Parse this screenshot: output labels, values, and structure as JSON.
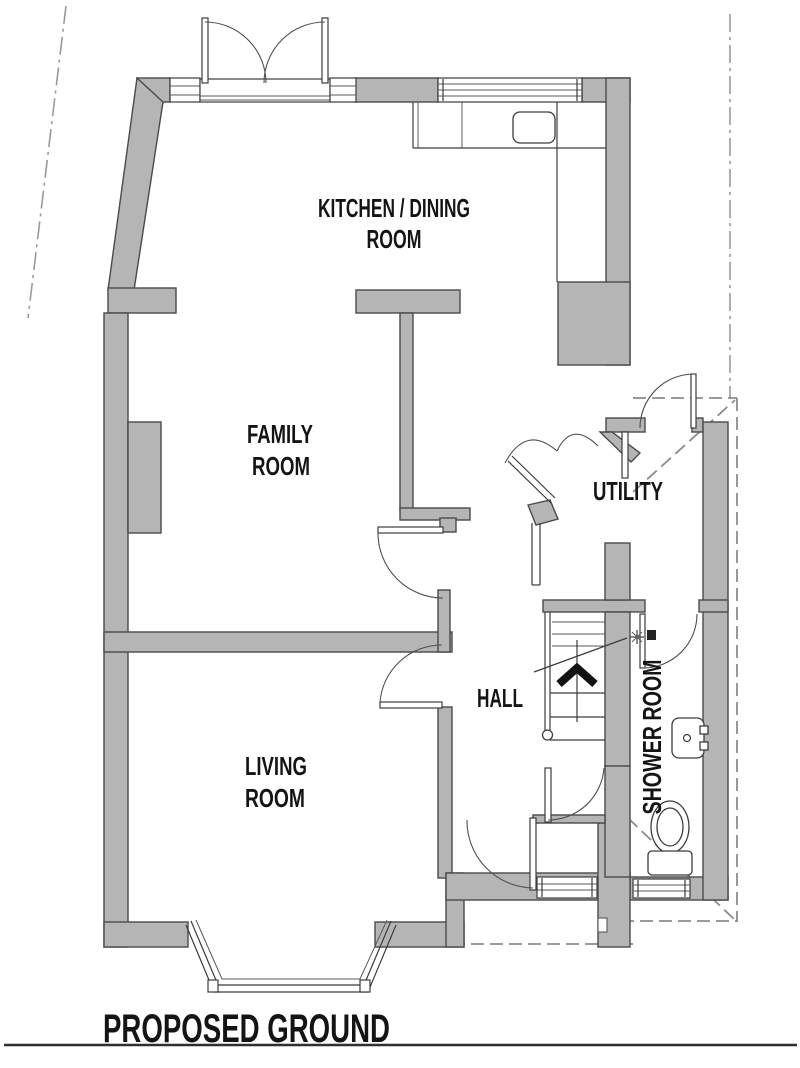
{
  "title": {
    "label": "PROPOSED GROUND"
  },
  "rooms": {
    "kitchen": {
      "line1": "KITCHEN / DINING",
      "line2": "ROOM"
    },
    "family": {
      "line1": "FAMILY",
      "line2": "ROOM"
    },
    "utility": {
      "label": "UTILITY"
    },
    "hall": {
      "label": "HALL"
    },
    "living": {
      "line1": "LIVING",
      "line2": "ROOM"
    },
    "shower": {
      "label": "SHOWER ROOM"
    }
  },
  "fixtures": {
    "sink": "kitchen-sink",
    "basin": "wash-basin",
    "toilet": "toilet",
    "shower_head": "shower-head",
    "stairs": "stairs-up-arrow",
    "bay_window": "bay-window",
    "french_doors": "french-doors"
  },
  "colors": {
    "wall_fill": "#b5b5b5",
    "wall_outline": "#4a4a4a",
    "line": "#3c3c3c",
    "dashed": "#8c8c8c",
    "text": "#141414",
    "background": "#ffffff"
  }
}
